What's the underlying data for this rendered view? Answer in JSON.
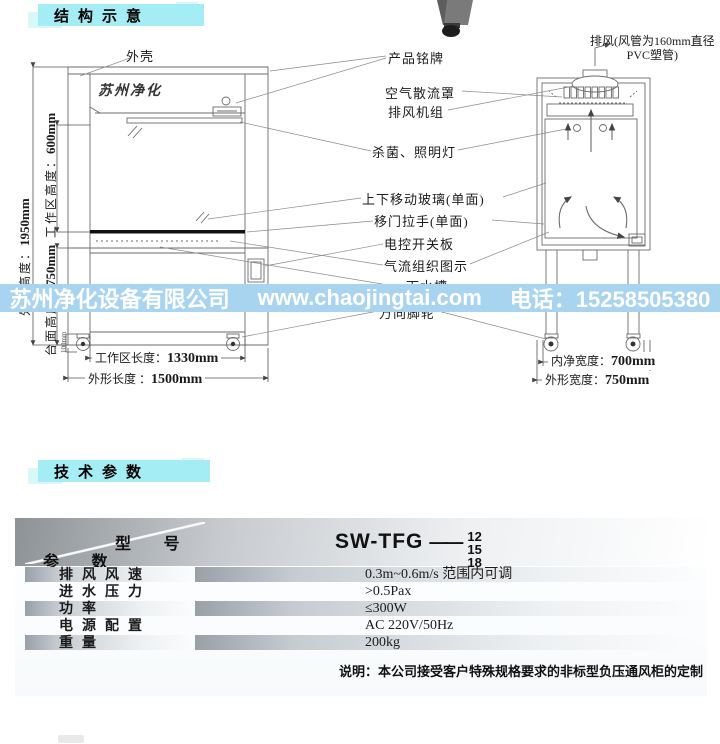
{
  "section_structure": {
    "title": "结构示意"
  },
  "section_specs": {
    "title": "技术参数"
  },
  "watermark": {
    "company": "苏州净化设备有限公司",
    "website": "www.chaojingtai.com",
    "phone": "电话：15258505380"
  },
  "colors": {
    "tab_cyan": "#a4edf4",
    "watermark_blue": "#a9d4ef",
    "sash_bar_black": "#111111"
  },
  "diagram": {
    "brand": "苏州净化",
    "labels": {
      "shell": "外壳",
      "nameplate": "产品铭牌",
      "exhaust_line1": "排风(风管为160mm直径",
      "exhaust_line2": "PVC塑管)",
      "diffuser": "空气散流罩",
      "fan_unit": "排风机组",
      "lamp": "杀菌、照明灯",
      "glass": "上下移动玻璃(单面)",
      "handle": "移门拉手(单面)",
      "control_panel": "电控开关板",
      "airflow": "气流组织图示",
      "sink": "下水槽",
      "casters": "万向脚轮"
    },
    "dims": {
      "overall_height": {
        "label": "外形高度：",
        "value": "1950mm"
      },
      "work_height": {
        "label": "工作区高度：",
        "value": "600mm"
      },
      "table_height": {
        "label": "台面高度：",
        "value": "750mm"
      },
      "foot_height": {
        "value": "100mm"
      },
      "work_length": {
        "label": "工作区长度：",
        "value": "1330mm"
      },
      "overall_length": {
        "label": "外形长度 ：",
        "value": "1500mm"
      },
      "inner_width": {
        "label": "内净宽度：",
        "value": "700mm"
      },
      "overall_width": {
        "label": "外形宽度：",
        "value": "750mm"
      }
    }
  },
  "spec_table": {
    "corner": {
      "model_label": "型 号",
      "param_label": "参 数"
    },
    "model": {
      "name": "SW-TFG",
      "dash": "——",
      "sizes": [
        "12",
        "15",
        "18"
      ]
    },
    "rows": [
      {
        "label": "排风风速",
        "value": "0.3m~0.6m/s 范围内可调"
      },
      {
        "label": "进水压力",
        "value": ">0.5Pax"
      },
      {
        "label": "功率",
        "value": "≤300W"
      },
      {
        "label": "电源配置",
        "value": "AC 220V/50Hz"
      },
      {
        "label": "重量",
        "value": "200kg"
      }
    ],
    "note": "说明：本公司接受客户特殊规格要求的非标型负压通风柜的定制"
  }
}
